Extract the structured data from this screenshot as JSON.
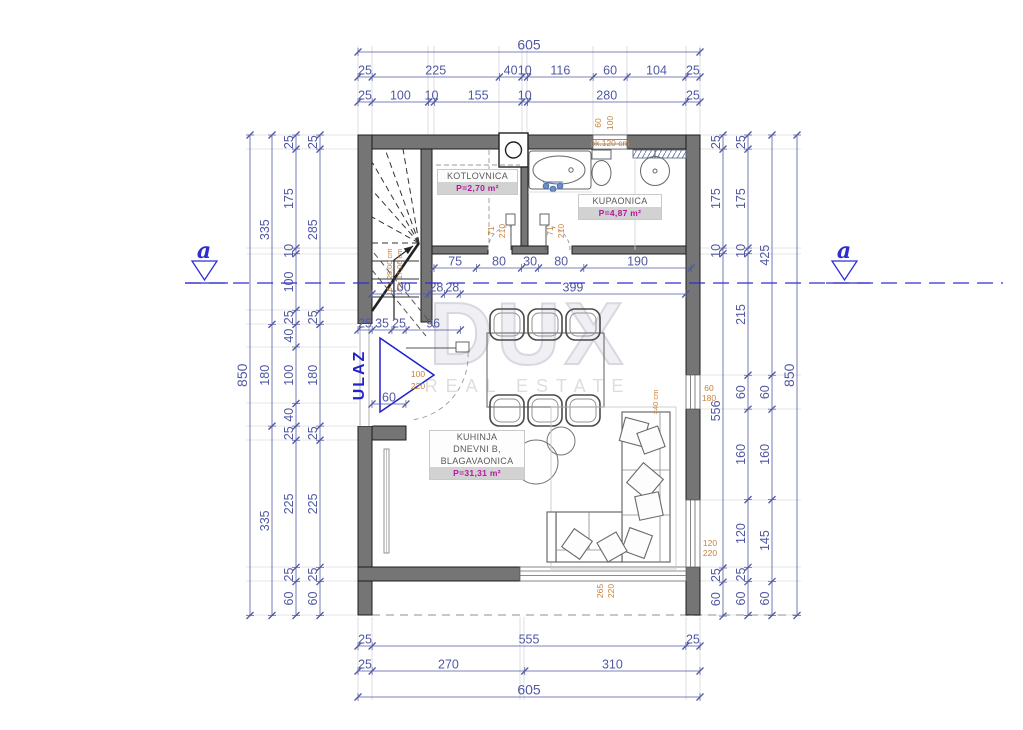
{
  "labels": {
    "ulaz": "ULAZ",
    "section_marker": "a"
  },
  "watermark": {
    "line1": "DUX",
    "line2": "REAL ESTATE"
  },
  "rooms": {
    "kotlovnica": {
      "name": "KOTLOVNICA",
      "area": "P=2,70 m²"
    },
    "kupaonica": {
      "name": "KUPAONICA",
      "area": "P=4,87 m²"
    },
    "kuhinja": {
      "name_line1": "KUHINJA",
      "name_line2": "DNEVNI B,",
      "name_line3": "BLAGAVAONICA",
      "area": "P=31,31 m²"
    }
  },
  "dimension_chains": [
    {
      "id": "top-total",
      "o": "h",
      "x0": 358,
      "y": 52,
      "big": true,
      "segments": [
        605
      ]
    },
    {
      "id": "top-row2",
      "o": "h",
      "x0": 358,
      "y": 77,
      "segments": [
        25,
        225,
        40,
        10,
        116,
        60,
        104,
        25
      ]
    },
    {
      "id": "top-row3",
      "o": "h",
      "x0": 358,
      "y": 102,
      "segments": [
        25,
        100,
        10,
        155,
        10,
        280,
        25
      ]
    },
    {
      "id": "mid-upper",
      "o": "h",
      "x0": 434,
      "y": 268,
      "segments": [
        75,
        80,
        30,
        80,
        190
      ]
    },
    {
      "id": "mid-lower",
      "o": "h",
      "x0": 372,
      "y": 294,
      "segments": [
        100,
        28,
        28,
        399
      ]
    },
    {
      "id": "entry-top",
      "o": "h",
      "x0": 358,
      "y": 330,
      "segments": [
        25,
        35,
        25,
        96
      ]
    },
    {
      "id": "entry-width",
      "o": "h",
      "x0": 372,
      "y": 404,
      "segments": [
        60
      ]
    },
    {
      "id": "bottom-row1",
      "o": "h",
      "x0": 358,
      "y": 646,
      "segments": [
        25,
        555,
        25
      ]
    },
    {
      "id": "bottom-row2",
      "o": "h",
      "x0": 358,
      "y": 671,
      "segments": [
        25,
        270,
        310
      ]
    },
    {
      "id": "bottom-total",
      "o": "h",
      "x0": 358,
      "y": 697,
      "big": true,
      "segments": [
        605
      ]
    },
    {
      "id": "left-total",
      "o": "v",
      "x": 250,
      "y0": 135,
      "big": true,
      "segments": [
        850
      ]
    },
    {
      "id": "left-2",
      "o": "v",
      "x": 272,
      "y0": 135,
      "segments": [
        335,
        180,
        335
      ]
    },
    {
      "id": "left-3",
      "o": "v",
      "x": 296,
      "y0": 135,
      "segments": [
        25,
        175,
        10,
        100,
        25,
        40,
        100,
        40,
        25,
        225,
        25,
        60
      ]
    },
    {
      "id": "left-4",
      "o": "v",
      "x": 320,
      "y0": 135,
      "segments": [
        25,
        285,
        25,
        180,
        25,
        225,
        25,
        60
      ]
    },
    {
      "id": "right-1",
      "o": "v",
      "x": 723,
      "y0": 135,
      "segments": [
        25,
        175,
        10,
        556,
        25,
        60
      ]
    },
    {
      "id": "right-2",
      "o": "v",
      "x": 748,
      "y0": 135,
      "segments": [
        25,
        175,
        10,
        215,
        60,
        160,
        120,
        25,
        60
      ]
    },
    {
      "id": "right-3",
      "o": "v",
      "x": 772,
      "y0": 135,
      "segments": [
        425,
        60,
        160,
        145,
        60
      ]
    },
    {
      "id": "right-total",
      "o": "v",
      "x": 797,
      "y0": 135,
      "big": true,
      "segments": [
        850
      ]
    }
  ],
  "annotations": [
    {
      "id": "stair-step-line1",
      "text": "16 x 28,00 cm",
      "x": 392,
      "y": 272,
      "rot": 1,
      "size": 7.5
    },
    {
      "id": "stair-step-line2",
      "text": "17 x 17,06 cm",
      "x": 402,
      "y": 272,
      "rot": 1,
      "size": 7.5
    },
    {
      "id": "door-kotlovnica-width",
      "text": "71",
      "x": 494,
      "y": 231,
      "rot": 1
    },
    {
      "id": "door-kotlovnica-height",
      "text": "210",
      "x": 505,
      "y": 231,
      "rot": 1
    },
    {
      "id": "door-kupaonica-width",
      "text": "71",
      "x": 553,
      "y": 231,
      "rot": 1
    },
    {
      "id": "door-kupaonica-height",
      "text": "210",
      "x": 564,
      "y": 231,
      "rot": 1
    },
    {
      "id": "window-top-width",
      "text": "60",
      "x": 601,
      "y": 123,
      "rot": 1
    },
    {
      "id": "window-top-height",
      "text": "100",
      "x": 613,
      "y": 123,
      "rot": 1
    },
    {
      "id": "toilet-note",
      "text": "pk.120 cm",
      "x": 610,
      "y": 146,
      "rot": 0
    },
    {
      "id": "entry-door-width",
      "text": "100",
      "x": 418,
      "y": 377,
      "rot": 0
    },
    {
      "id": "entry-door-height",
      "text": "220",
      "x": 418,
      "y": 389,
      "rot": 0
    },
    {
      "id": "window-right1-width",
      "text": "60",
      "x": 709,
      "y": 391,
      "rot": 0
    },
    {
      "id": "window-right1-height",
      "text": "180",
      "x": 709,
      "y": 401,
      "rot": 0
    },
    {
      "id": "parapet-note",
      "text": "=40 cm",
      "x": 658,
      "y": 402,
      "rot": 1,
      "size": 7.5
    },
    {
      "id": "window-right2-width",
      "text": "120",
      "x": 710,
      "y": 546,
      "rot": 0
    },
    {
      "id": "window-right2-height",
      "text": "220",
      "x": 710,
      "y": 556,
      "rot": 0
    },
    {
      "id": "window-bottom-width",
      "text": "265",
      "x": 603,
      "y": 591,
      "rot": 1
    },
    {
      "id": "window-bottom-height",
      "text": "220",
      "x": 614,
      "y": 591,
      "rot": 1
    }
  ],
  "colors": {
    "dimension": "#5058a2",
    "annotation": "#c8813b",
    "section": "#2e2ed0",
    "entry_arrow": "#2222cc",
    "area_text": "#b5189e",
    "wall": "#757575",
    "watermark": "#d8d8e0"
  }
}
